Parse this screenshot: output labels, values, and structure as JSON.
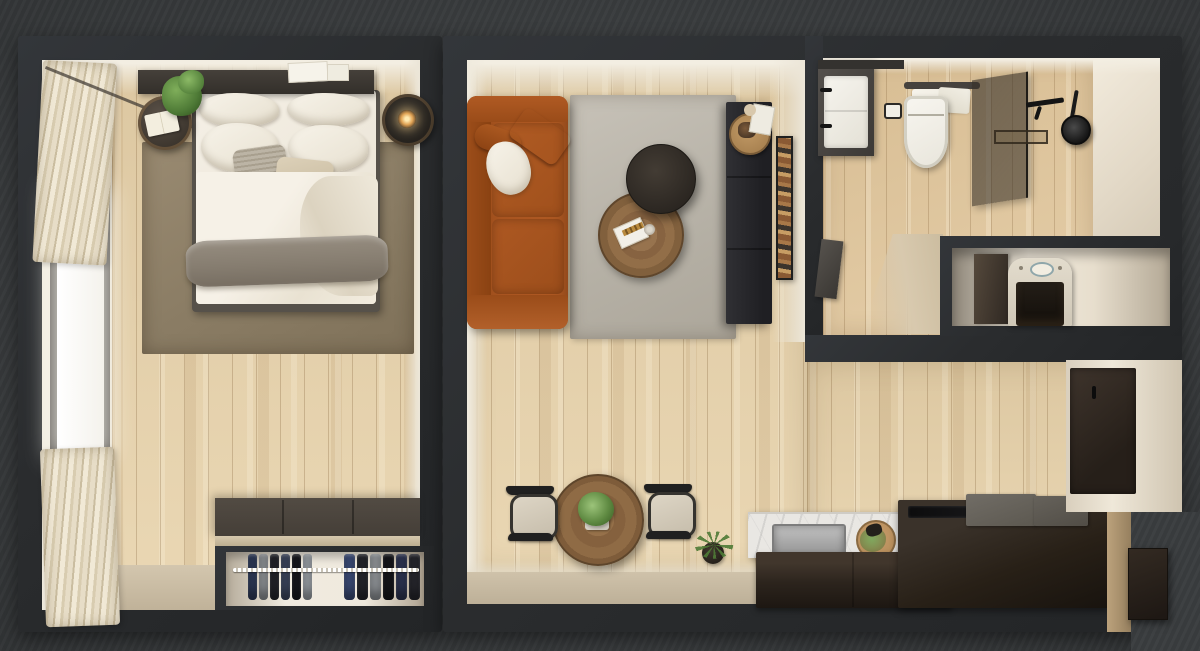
{
  "scene": {
    "title": "Top-down 3D render of a one-bedroom apartment floor plan",
    "background_color": "#3a3d3f",
    "rooms": {
      "bedroom": {
        "label": "Bedroom",
        "items": [
          "double bed with white duvet and gray throw",
          "dark headboard shelf with papers",
          "round nightstand with open book",
          "potted plant",
          "side table with lit lamp",
          "brown area rug",
          "window with striped curtains",
          "wardrobe cutaway with folded clothes on rail"
        ]
      },
      "living_room": {
        "label": "Living room",
        "items": [
          "cognac leather sofa with white and brown cushions",
          "dark round coffee table",
          "walnut round coffee table with magazine and glass",
          "black media sideboard with round tray and papers",
          "leaning art print",
          "gray area rug"
        ]
      },
      "dining_area": {
        "label": "Dining area",
        "items": [
          "round walnut table with white planter and greenery",
          "two black-frame chairs with beige seats",
          "small floor plant"
        ]
      },
      "kitchen": {
        "label": "Kitchen",
        "items": [
          "dark brown counter blocks",
          "white marble backsplash",
          "stainless sink",
          "round cutting board with herbs",
          "black cooktop strip",
          "gray appliance lids",
          "tall dark end panel"
        ]
      },
      "bathroom": {
        "label": "Bathroom",
        "items": [
          "dark vanity with white basin and black faucets",
          "wall-hung toilet",
          "towel rail with white towels",
          "toilet paper holder",
          "tinted glass shower screen",
          "black rain shower head with arm",
          "linear floor drain"
        ]
      },
      "utility_closet": {
        "label": "Utility closet",
        "items": [
          "washing machine in niche",
          "dark cabinet door ajar"
        ]
      },
      "entry": {
        "label": "Entry",
        "items": [
          "recessed entrance door with handle"
        ]
      }
    },
    "palette": {
      "background": "#3a3d3f",
      "walls": "#2b2d2f",
      "wall_faces": "#efe8da",
      "wood_floor": "#e8d4ae",
      "bath_floor": "#e2c89e",
      "bedroom_rug": "#8f8169",
      "living_rug": "#bcb7ad",
      "sofa_leather": "#a85420",
      "counters": "#2c241d",
      "marble": "#e9e7e3",
      "bedding": "#f2ece1",
      "throw": "#8c8376",
      "door": "#32291f",
      "curtain": "#e9dfc9",
      "plant": "#4e7a36",
      "lamp_glow": "#ffe7ae"
    },
    "closet": {
      "clothes_left": [
        "#2e3a58",
        "#8e9296",
        "#23242a",
        "#3c465e",
        "#17181d",
        "#9aa0a6"
      ],
      "clothes_right": [
        "#3a4a74",
        "#23242a",
        "#8e9296",
        "#14151a",
        "#2c3350",
        "#26262c"
      ]
    }
  }
}
